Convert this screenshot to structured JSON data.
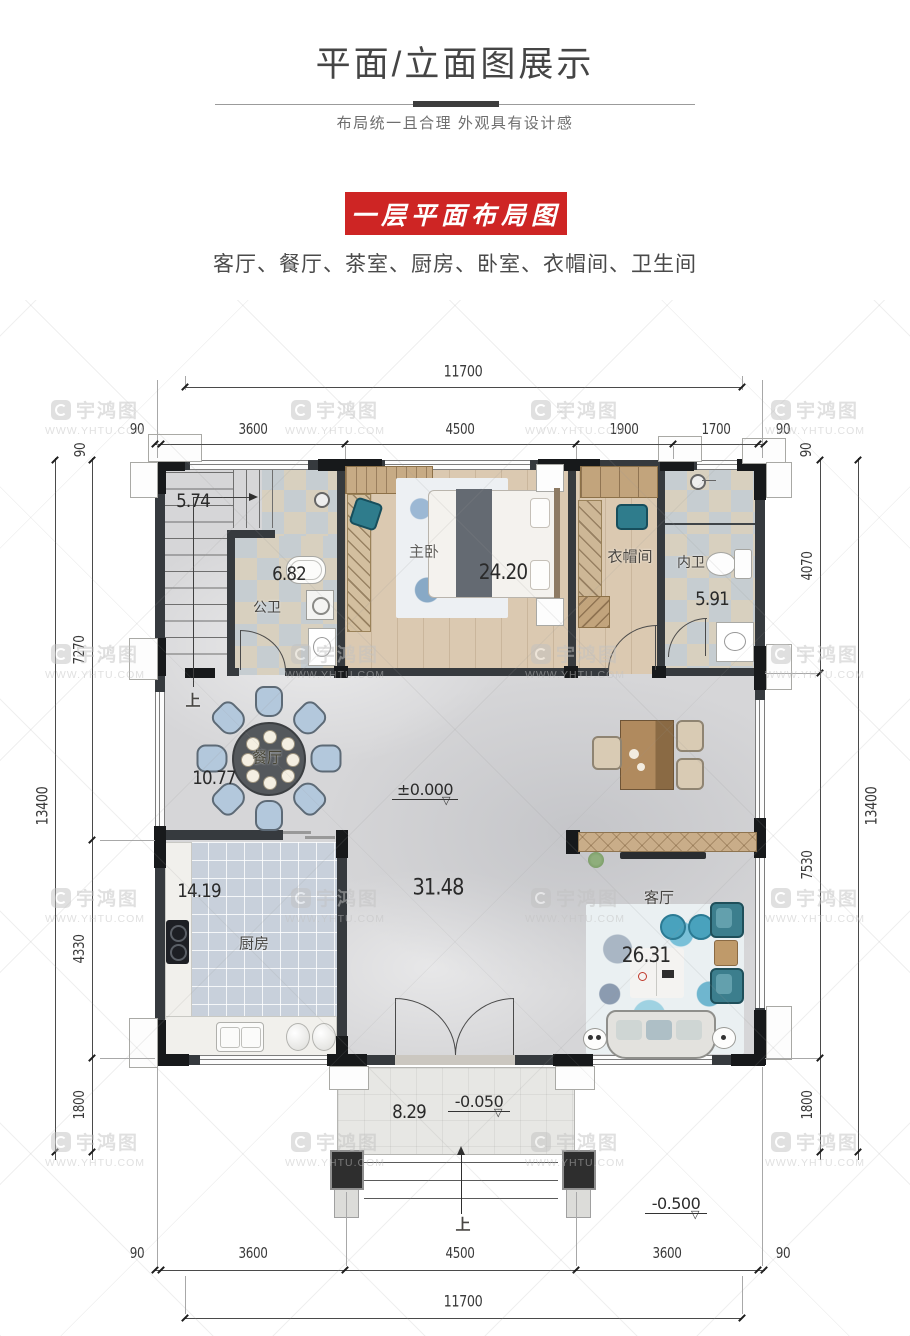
{
  "header": {
    "title": "平面/立面图展示",
    "subtitle": "布局统一且合理 外观具有设计感"
  },
  "section": {
    "banner": "一层平面布局图",
    "room_list": "客厅、餐厅、茶室、厨房、卧室、衣帽间、卫生间"
  },
  "watermark": {
    "brand": "宇鸿图",
    "url": "WWW.YHTU.COM"
  },
  "colors": {
    "banner_red": "#ce2524",
    "wall_dark": "#363a3e",
    "teal_accent": "#2f7c8c"
  },
  "plan": {
    "rooms": {
      "stair": {
        "area": "5.74",
        "up_label": "上"
      },
      "public_bath": {
        "name": "公卫",
        "area": "6.82"
      },
      "master_bedroom": {
        "name": "主卧",
        "area": "24.20"
      },
      "cloakroom": {
        "name": "衣帽间"
      },
      "ensuite_bath": {
        "name": "内卫",
        "area": "5.91"
      },
      "dining": {
        "name": "餐厅",
        "area": "10.77"
      },
      "hall": {
        "area": "31.48"
      },
      "kitchen": {
        "name": "厨房",
        "area": "14.19"
      },
      "living": {
        "name": "客厅",
        "area": "26.31"
      },
      "porch": {
        "area": "8.29",
        "up_label": "上"
      }
    },
    "levels": {
      "ground": "±0.000",
      "porch": "-0.050",
      "yard": "-0.500"
    },
    "dims": {
      "top": {
        "total": "11700",
        "segments": [
          "90",
          "3600",
          "4500",
          "1900",
          "1700",
          "90"
        ]
      },
      "bottom": {
        "total": "11700",
        "segments": [
          "90",
          "3600",
          "4500",
          "3600",
          "90"
        ]
      },
      "left": {
        "total": "13400",
        "segments": [
          "90",
          "7270",
          "4330",
          "1800"
        ]
      },
      "right": {
        "total": "13400",
        "segments": [
          "90",
          "4070",
          "7530",
          "1800"
        ]
      }
    }
  }
}
